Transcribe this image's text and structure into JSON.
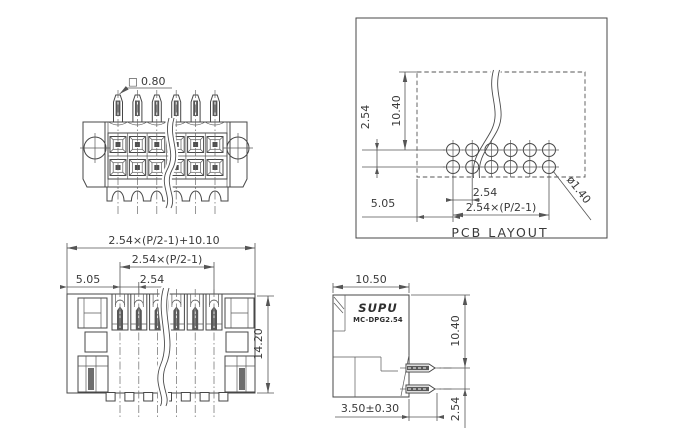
{
  "front_view": {
    "square_symbol": "□",
    "pin_size": "0.80"
  },
  "pcb_layout": {
    "title": "PCB LAYOUT",
    "row_pitch": "2.54",
    "row_offset": "10.40",
    "col_pitch": "2.54",
    "col_span": "2.54×(P/2-1)",
    "edge_offset": "5.05",
    "hole_dia": "ø1.40"
  },
  "rear_view": {
    "total_width": "2.54×(P/2-1)+10.10",
    "col_span": "2.54×(P/2-1)",
    "edge_offset": "5.05",
    "col_pitch": "2.54",
    "height": "14.20"
  },
  "side_view": {
    "width": "10.50",
    "brand": "SUPU",
    "model": "MC-DPG2.54",
    "body_height": "10.40",
    "pin_pitch": "2.54",
    "pin_length": "3.50±0.30"
  },
  "colors": {
    "line": "#474747",
    "dimension": "#555555",
    "dark_fill": "#575757",
    "background": "#ffffff"
  }
}
